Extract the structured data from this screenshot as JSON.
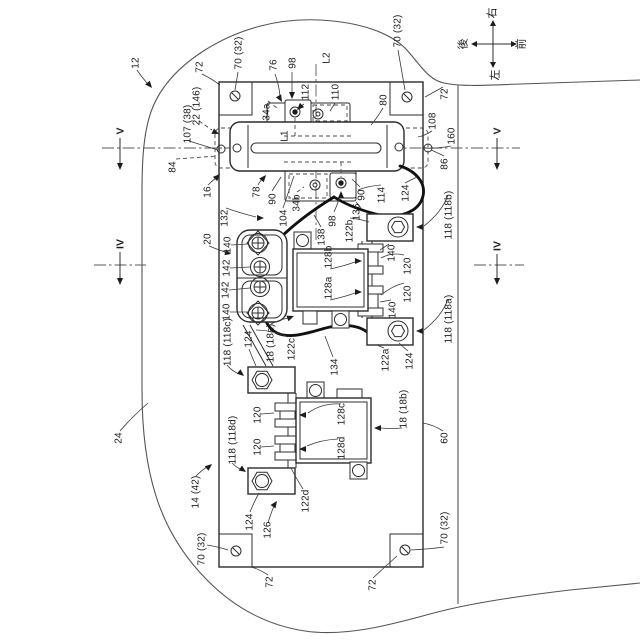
{
  "compass": {
    "up": "右",
    "down": "左",
    "left": "後",
    "right": "前"
  },
  "section_markers": {
    "v": "V",
    "iv": "IV"
  },
  "axis_labels": {
    "l1": "L1",
    "l2": "L2"
  },
  "refs": {
    "r12": "12",
    "r14_42": "14 (42)",
    "r16": "16",
    "r18_18a": "18 (18a)",
    "r18_18b": "18 (18b)",
    "r20": "20",
    "r22_146": "22 (146)",
    "r24": "24",
    "r34a": "34a",
    "r34b": "34b",
    "r60": "60",
    "r70_32": "70 (32)",
    "r72": "72",
    "r76": "76",
    "r78": "78",
    "r80": "80",
    "r84": "84",
    "r86": "86",
    "r90": "90",
    "r98": "98",
    "r104": "104",
    "r107_38": "107 (38)",
    "r108": "108",
    "r110": "110",
    "r112": "112",
    "r114": "114",
    "r118_118a": "118 (118a)",
    "r118_118b": "118 (118b)",
    "r118_118c": "118 (118c)",
    "r118_118d": "118 (118d)",
    "r120": "120",
    "r122a": "122a",
    "r122b": "122b",
    "r122c": "122c",
    "r122d": "122d",
    "r124": "124",
    "r126": "126",
    "r128a": "128a",
    "r128b": "128b",
    "r128c": "128c",
    "r128d": "128d",
    "r132": "132",
    "r134": "134",
    "r136": "136",
    "r138": "138",
    "r140": "140",
    "r142": "142",
    "r160": "160"
  }
}
